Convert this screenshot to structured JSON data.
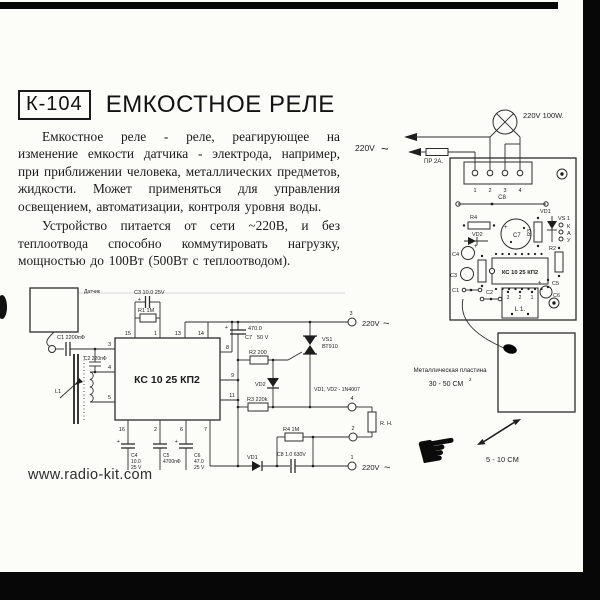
{
  "page": {
    "code": "К-104",
    "title": "ЕМКОСТНОЕ РЕЛЕ",
    "website": "www.radio-kit.com"
  },
  "description": {
    "para1": "Емкостное реле - реле, реагирующее на изменение емкости датчика - электрода, например, при приближении человека, металлических предметов, жидкости. Может применяться для управления освещением, автоматизации, контроля уровня воды.",
    "para2": "Устройство питается от сети ~220В, и без теплоотвода способно коммутировать нагрузку, мощностью до 100Вт (500Вт с теплоотводом)."
  },
  "wiring": {
    "mains": "220V",
    "tilde": "~",
    "fuse_label": "ПР 2А.",
    "lamp_label": "220V 100W."
  },
  "pcb": {
    "board_terminals": [
      "1",
      "2",
      "3",
      "4"
    ],
    "c8": "С8",
    "r4": "R4",
    "vd2": "VD2",
    "c7": "C7",
    "plus": "+",
    "r3": "R3",
    "vd1": "VD1",
    "vs1": "VS 1",
    "pin_k": "К",
    "pin_a": "А",
    "pin_y": "У",
    "c4": "C4",
    "c3": "C3",
    "ic": "КС 10 25 КП2",
    "r2": "R2",
    "c5": "C5",
    "c1": "C1",
    "c2": "C2",
    "l1": "L 1.",
    "l1_pins": [
      "3",
      "2",
      "1"
    ],
    "c6": "C6"
  },
  "plate": {
    "line1": "Металлическая пластина",
    "line2": "30 - 50 СМ",
    "sup": "2",
    "distance": "5 - 10 СМ"
  },
  "hand_icon": "☛",
  "schematic": {
    "sensor": "Датчик",
    "c1": "С1 2200пФ",
    "c2": "С2 220пФ",
    "l1": "L1",
    "c3": "С3 10.0 25V",
    "r1": "R1 1M",
    "ic": "КС 10 25 КП2",
    "pins_top": [
      "15",
      "1",
      "13",
      "14"
    ],
    "pins_left": [
      "3",
      "4",
      "5"
    ],
    "pins_right": [
      "8",
      "9",
      "11"
    ],
    "pins_bottom": [
      "16",
      "2",
      "6",
      "7"
    ],
    "plus": "+",
    "c7": "C7",
    "c7_val": "470.0",
    "c7_volt": "50 V",
    "r2": "R2 200",
    "vs1": "VS1",
    "vs1_type": "ВТ910",
    "vd2": "VD2",
    "diode_note": "VD1, VD2 - 1N4007",
    "r3": "R3 220k",
    "r4": "R4 1M",
    "vd1": "VD1",
    "c8": "С8 1.0 630V",
    "c4": [
      "C4",
      "10.0",
      "25 V"
    ],
    "c5": [
      "C5",
      "4700пФ"
    ],
    "c6": [
      "C6",
      "47.0",
      "25 V"
    ],
    "t1": "1",
    "t2": "2",
    "t3": "3",
    "t4": "4",
    "mains": "220V",
    "tilde": "~",
    "load": "R. Н."
  }
}
